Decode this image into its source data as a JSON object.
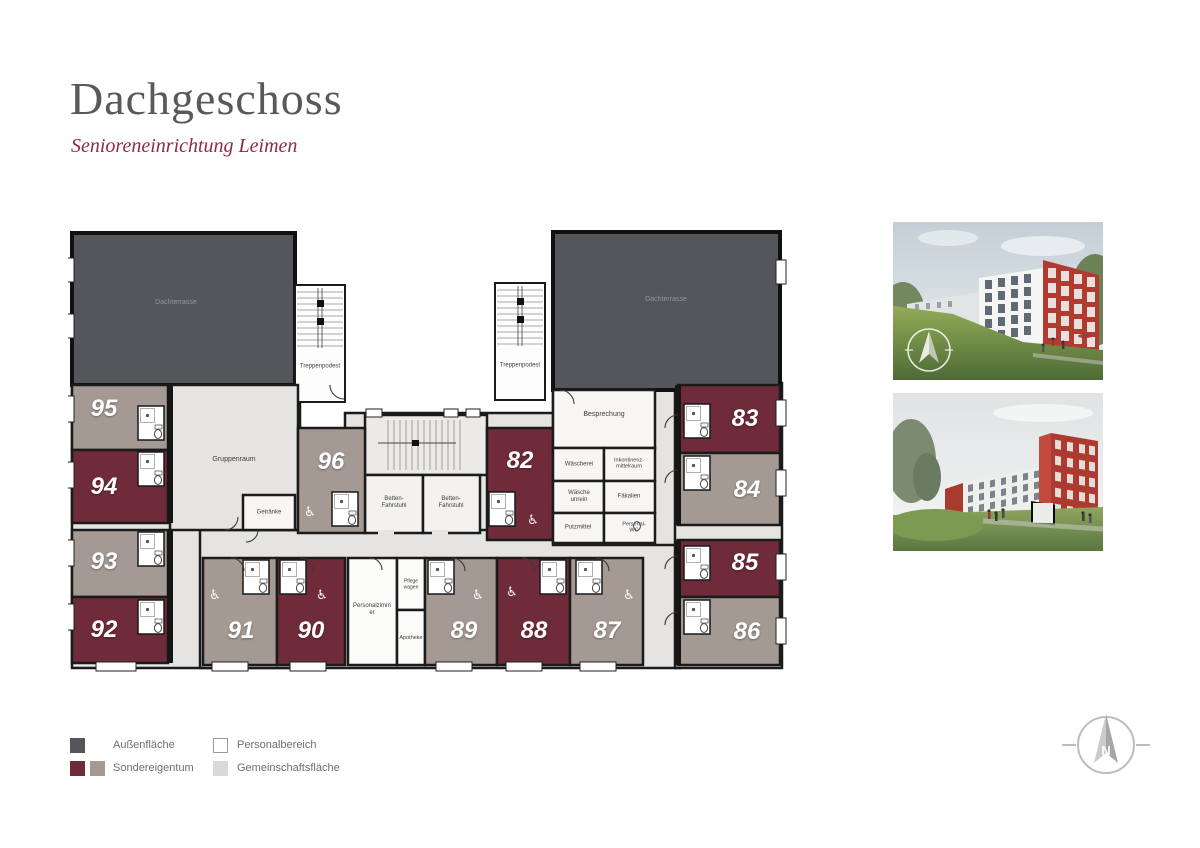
{
  "page": {
    "title": "Dachgeschoss",
    "subtitle": "Senioreneinrichtung Leimen"
  },
  "floorplan": {
    "terraces": {
      "left": "Dachterrasse",
      "right": "Dachterrasse"
    },
    "stairs": {
      "left": "Treppenpodest",
      "right": "Treppenpodest"
    },
    "common_rooms": {
      "gruppenraum": "Gruppenraum",
      "getraenke": "Getränke",
      "betten_fahrstuhl_1": "Betten-Fahrstuhl",
      "betten_fahrstuhl_2": "Betten-Fahrstuhl",
      "besprechung": "Besprechung",
      "waescherei": "Wäscherei",
      "inkontinenzmittelraum": "Inkontinenz-mittelraum",
      "waesche_unrein": "Wäsche unrein",
      "faekalien": "Fäkalien",
      "putzmittel": "Putzmittel",
      "personal_wc": "Personal-WC",
      "personalzimmer": "Personalzimmer",
      "pflegewagen": "Pflegewagen",
      "apotheke": "Apotheke"
    },
    "room_numbers": {
      "r82": "82",
      "r83": "83",
      "r84": "84",
      "r85": "85",
      "r86": "86",
      "r87": "87",
      "r88": "88",
      "r89": "89",
      "r90": "90",
      "r91": "91",
      "r92": "92",
      "r93": "93",
      "r94": "94",
      "r95": "95",
      "r96": "96"
    }
  },
  "legend": {
    "items": [
      {
        "label": "Außenfläche",
        "swatches": [
          "#55565a"
        ]
      },
      {
        "label": "Sondereigentum",
        "swatches": [
          "#6f2b39",
          "#a49a93"
        ]
      },
      {
        "label": "Personalbereich",
        "swatches": [
          "#ffffff"
        ]
      },
      {
        "label": "Gemeinschaftsfläche",
        "swatches": [
          "#dcdad8"
        ]
      }
    ]
  },
  "compass": {
    "north_label": "N"
  },
  "colors": {
    "outdoor_terrace": "#55565a",
    "special_property_red": "#6f2b39",
    "special_property_taupe": "#a49a93",
    "community_area": "#e6e4e2",
    "staff_area": "#ffffff",
    "walls": "#1b1b1b",
    "title_text": "#59595c",
    "subtitle_text": "#8e2c3e",
    "photo_building_red": "#b23b31"
  }
}
